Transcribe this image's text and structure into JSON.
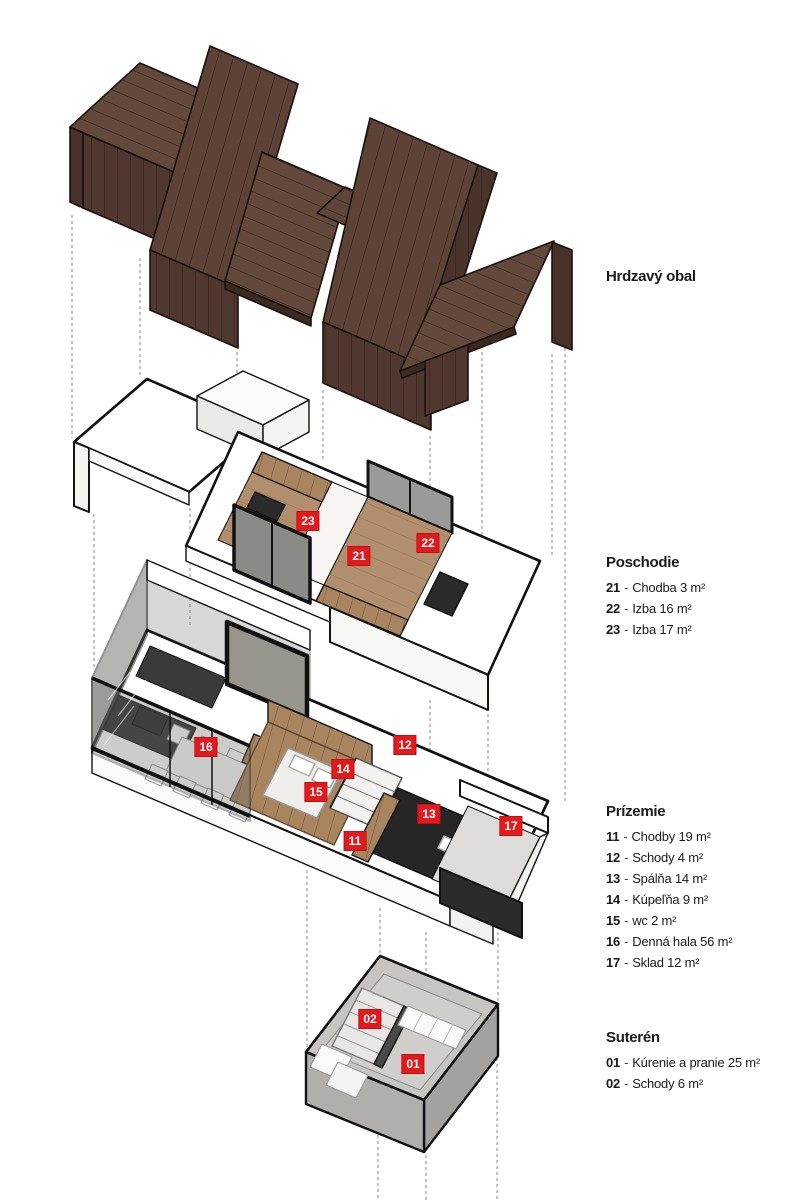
{
  "colors": {
    "accent_red": "#e2191d",
    "tag_text": "#ffffff",
    "roof_flat": "#63483c",
    "roof_tilted": "#5d4237",
    "roof_fascia": "#503831",
    "roof_flap": "#47312a",
    "wood_floor": "#b18e6e",
    "wood_cabinet": "#a8845f",
    "furniture_dark": "#2e2e2e",
    "glass_gray": "#96968f",
    "concrete_gray": "#b0afac",
    "outline_black": "#111111",
    "guide_gray": "#8a8a8a",
    "text_color": "#1a1a1a"
  },
  "legend": {
    "separator": "-",
    "sections": [
      {
        "heading": "Hrdzavý obal",
        "items": []
      },
      {
        "heading": "Poschodie",
        "items": [
          {
            "num": "21",
            "text": "Chodba 3 m²"
          },
          {
            "num": "22",
            "text": "Izba 16 m²"
          },
          {
            "num": "23",
            "text": "Izba 17 m²"
          }
        ]
      },
      {
        "heading": "Prízemie",
        "items": [
          {
            "num": "11",
            "text": "Chodby 19 m²"
          },
          {
            "num": "12",
            "text": "Schody 4 m²"
          },
          {
            "num": "13",
            "text": "Spálňa 14 m²"
          },
          {
            "num": "14",
            "text": "Kúpeľňa 9 m²"
          },
          {
            "num": "15",
            "text": "wc 2 m²"
          },
          {
            "num": "16",
            "text": "Denná hala 56 m²"
          },
          {
            "num": "17",
            "text": "Sklad 12 m²"
          }
        ]
      },
      {
        "heading": "Suterén",
        "items": [
          {
            "num": "01",
            "text": "Kúrenie a pranie 25 m²"
          },
          {
            "num": "02",
            "text": "Schody 6 m²"
          }
        ]
      }
    ]
  },
  "floor_tags": {
    "poschodie": [
      {
        "label": "23"
      },
      {
        "label": "21"
      },
      {
        "label": "22"
      }
    ],
    "prizemie": [
      {
        "label": "16"
      },
      {
        "label": "12"
      },
      {
        "label": "14"
      },
      {
        "label": "15"
      },
      {
        "label": "13"
      },
      {
        "label": "11"
      },
      {
        "label": "17"
      }
    ],
    "suteren": [
      {
        "label": "02"
      },
      {
        "label": "01"
      }
    ]
  }
}
